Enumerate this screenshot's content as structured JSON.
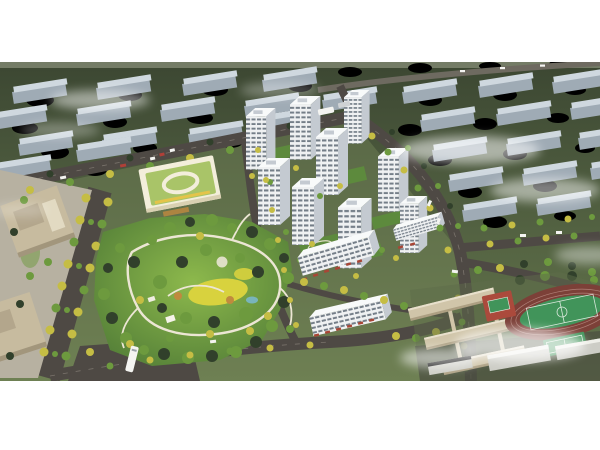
{
  "image": {
    "type": "architectural aerial rendering",
    "subject": "Bird's-eye masterplan rendering of a residential community with central park, white high-rise towers, kindergarten, school and sports fields",
    "atmosphere": "daytime, hazy background city blocks with drifting white mist"
  },
  "regions": {
    "background_city": "rows of pale blue-gray mid-rise slabs set in dark green tree canopy, upper road with small cars",
    "residential_towers": {
      "count": 9,
      "style": "white high-rise slabs with dark horizontal window bands and white roofs"
    },
    "midrise_blocks": {
      "count": 3,
      "feature": "white slabs with red storefront awnings along the streets"
    },
    "central_park": {
      "features": [
        "winding white footpaths",
        "yellow meadow lawn",
        "white pavilions",
        "small pond",
        "dense mixed green trees"
      ]
    },
    "kindergarten": {
      "feature": "cream building with flat light-green roof and white oval courtyard ring"
    },
    "office_buildings": {
      "count": 2,
      "style": "tan stone blocks with roof terraces on a gray plaza"
    },
    "school_campus": {
      "style": "tan linear classroom wings linked by corridors"
    },
    "sports_facilities": [
      "dark-red oval running track",
      "green soccer pitch with white markings",
      "red basketball court zone",
      "green court"
    ],
    "roads": [
      "tree-lined boulevard on the left",
      "top boundary road with intersection",
      "curved right boundary road",
      "wide dark bottom road",
      "internal streets"
    ],
    "vehicles": [
      "white bus on bottom boulevard",
      "bus and cars at top intersection",
      "cars on background road"
    ],
    "street_trees": "alternating autumn-yellow and green trees lining every road",
    "mist": "soft white fog streaks over background blocks and the lower-right corner"
  },
  "palette": {
    "page_bg": "#ffffff",
    "terrain_top": "#3c4732",
    "terrain_mid": "#4d5b3e",
    "terrain_low": "#66784d",
    "site_lawn": "#7a8c5c",
    "bg_slab_top": "#cfd8df",
    "bg_slab_face": "#9fabb5",
    "tree_dark": "#31402b",
    "tree_green": "#6d9a3e",
    "tree_yellow": "#c5bd44",
    "tree_orange": "#c08a3e",
    "road_main": "#4e4944",
    "road_dash": "#8d867e",
    "path_white": "#ece6d4",
    "meadow_yellow": "#d8d23e",
    "park_green_light": "#8db94c",
    "park_green_dark": "#4f7a36",
    "courtyard_green": "#5d8a3d",
    "tower_face": "#eff1f2",
    "tower_window": "#5e6a76",
    "tower_side": "#c4cad1",
    "tower_roof": "#f8fafa",
    "kindergarten_roof": "#a9c468",
    "kindergarten_face": "#f3eedb",
    "kindergarten_side": "#d9d0b2",
    "accent_yellow": "#e4c44a",
    "awning_red": "#a84636",
    "office_tan": "#c7bb9f",
    "office_side": "#a2967c",
    "plaza_gray": "#b7b1a1",
    "school_tan": "#d0c5a9",
    "school_side": "#ac9f82",
    "court_red": "#ab4a3c",
    "pitch_green": "#41945a",
    "track_red": "#7c4038",
    "gray_building": "#cdcdc6",
    "car_white": "#f4f4f1",
    "car_red": "#b04038",
    "mist_white": "#ffffff"
  }
}
